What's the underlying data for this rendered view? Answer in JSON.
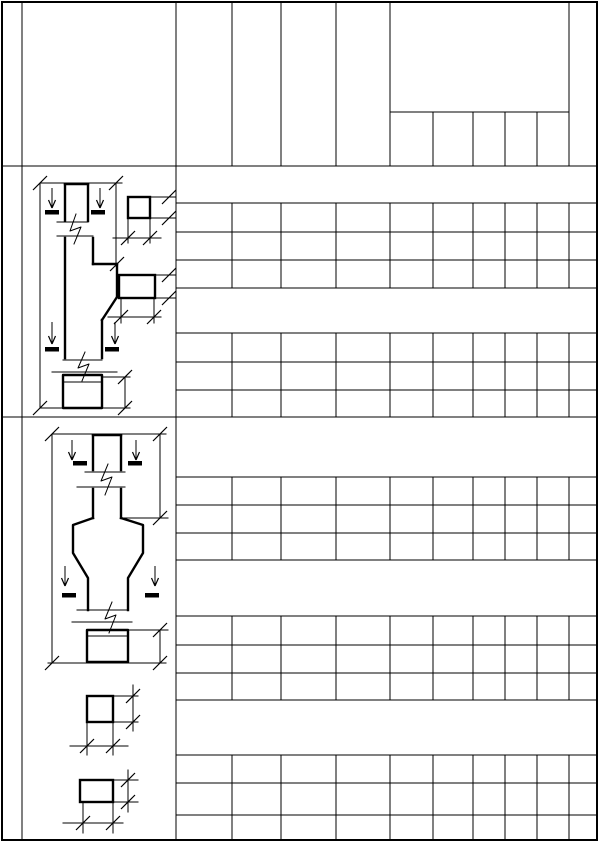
{
  "sheet": {
    "width": 601,
    "height": 842,
    "background": "#ffffff",
    "line_color": "#000000",
    "thin": 1,
    "thick": 2.4,
    "frame_stroke": 2,
    "dash_width": 4.5,
    "tick_len": 7
  },
  "frame": {
    "x": 2,
    "y": 2,
    "w": 595,
    "h": 838
  },
  "grid_page": {
    "segments": [
      [
        22,
        2,
        22,
        840
      ],
      [
        176,
        2,
        176,
        840
      ],
      [
        2,
        166,
        597,
        166
      ],
      [
        2,
        417,
        597,
        417
      ]
    ]
  },
  "grid_header": {
    "segments": [
      [
        232,
        2,
        232,
        166
      ],
      [
        281,
        2,
        281,
        166
      ],
      [
        336,
        2,
        336,
        166
      ],
      [
        390,
        2,
        390,
        166
      ],
      [
        569,
        2,
        569,
        166
      ],
      [
        390,
        112,
        569,
        112
      ],
      [
        433,
        112,
        433,
        166
      ],
      [
        473,
        112,
        473,
        166
      ],
      [
        505,
        112,
        505,
        166
      ],
      [
        537,
        112,
        537,
        166
      ]
    ]
  },
  "schedule": {
    "x_left": 176,
    "x_right": 597,
    "col_xs": [
      232,
      281,
      336,
      390,
      433,
      473,
      505,
      537,
      569
    ],
    "blocks": [
      {
        "top": 203,
        "rows": [
          232,
          260
        ],
        "bottom": 288
      },
      {
        "top": 333,
        "rows": [
          362,
          390
        ],
        "bottom": 417
      },
      {
        "top": 477,
        "rows": [
          505,
          533
        ],
        "bottom": 560
      },
      {
        "top": 616,
        "rows": [
          645,
          673
        ],
        "bottom": 700
      },
      {
        "top": 755,
        "rows": [
          783,
          815
        ],
        "bottom": 840
      }
    ]
  },
  "drawings": {
    "col1": {
      "thick": [
        "M65,184 L88,184",
        "M65,184 L65,221",
        "M88,184 L88,221",
        "M65,238 L65,358",
        "M93,238 L93,264",
        "M93,264 L117,264",
        "M117,264 L117,297",
        "M117,297 L102,320",
        "M102,320 L102,358",
        "M63,375 L102,375 L102,408 L63,408 Z"
      ],
      "thin": [
        "M40,183 L40,408",
        "M40,183 L122,183",
        "M116,184 L116,266",
        "M57,222 L88,222",
        "M57,236 L93,236",
        "M76,214 L70,231 L81,227 L74,244",
        "M63,360 L102,360",
        "M52,372 L117,372",
        "M85,352 L78,368 L89,364 L82,381",
        "M63,382 L102,382",
        "M40,408 L130,408",
        "M102,377 L130,377",
        "M125,377 L125,408"
      ],
      "ticks": [
        [
          40,
          183
        ],
        [
          116,
          183
        ],
        [
          117,
          264
        ],
        [
          40,
          408
        ],
        [
          125,
          408
        ],
        [
          125,
          377
        ]
      ],
      "arrows": [
        [
          52,
          188,
          208
        ],
        [
          100,
          188,
          208
        ],
        [
          52,
          322,
          344
        ],
        [
          115,
          322,
          344
        ]
      ],
      "dashes": [
        [
          45,
          212,
          59
        ],
        [
          91,
          212,
          105
        ],
        [
          45,
          349,
          59
        ],
        [
          105,
          349,
          119
        ]
      ]
    },
    "sec1a": {
      "rects": [
        [
          128,
          197,
          22,
          21
        ]
      ],
      "thin": [
        "M150,197 L176,197",
        "M150,218 L176,218",
        "M128,218 L128,243",
        "M150,218 L150,243",
        "M113,238 L161,238"
      ],
      "ticks": [
        [
          169,
          197
        ],
        [
          169,
          218
        ],
        [
          128,
          238
        ],
        [
          150,
          238
        ]
      ]
    },
    "sec1b": {
      "rects": [
        [
          119,
          275,
          36,
          23
        ]
      ],
      "thin": [
        "M155,275 L176,275",
        "M155,298 L176,298",
        "M121,298 L121,323",
        "M154,298 L154,323",
        "M108,317 L161,317"
      ],
      "ticks": [
        [
          169,
          275
        ],
        [
          169,
          298
        ],
        [
          121,
          317
        ],
        [
          154,
          317
        ]
      ]
    },
    "col2": {
      "thick": [
        "M93,435 L121,435",
        "M93,435 L93,470",
        "M121,435 L121,470",
        "M93,489 L93,518",
        "M121,489 L121,518",
        "M93,518 L73,525 L73,553 L88,578 L88,610",
        "M121,518 L143,525 L143,553 L128,578 L128,610",
        "M87,630 L128,630 L128,662 L87,662 Z"
      ],
      "thin": [
        "M52,434 L52,663",
        "M52,434 L166,434",
        "M160,434 L160,518",
        "M123,518 L168,518",
        "M85,472 L125,472",
        "M77,487 L125,487",
        "M108,464 L101,481 L112,477 L105,495",
        "M77,610 L128,610",
        "M72,622 L132,622",
        "M112,602 L105,619 L116,615 L109,633",
        "M87,636 L128,636",
        "M48,663 L166,663",
        "M128,630 L168,630",
        "M160,630 L160,663"
      ],
      "ticks": [
        [
          52,
          434
        ],
        [
          160,
          434
        ],
        [
          160,
          518
        ],
        [
          52,
          663
        ],
        [
          160,
          663
        ],
        [
          160,
          630
        ]
      ],
      "arrows": [
        [
          72,
          440,
          460
        ],
        [
          136,
          440,
          460
        ],
        [
          65,
          566,
          586
        ],
        [
          155,
          566,
          586
        ]
      ],
      "dashes": [
        [
          73,
          463,
          87
        ],
        [
          128,
          463,
          142
        ],
        [
          62,
          595,
          76
        ],
        [
          145,
          595,
          159
        ]
      ]
    },
    "sec2a": {
      "rects": [
        [
          87,
          696,
          26,
          26
        ]
      ],
      "thin": [
        "M113,696 L138,696",
        "M113,722 L138,722",
        "M133,685 L133,731",
        "M87,722 L87,755",
        "M113,722 L113,755",
        "M70,746 L128,746"
      ],
      "ticks": [
        [
          133,
          696
        ],
        [
          133,
          722
        ],
        [
          87,
          746
        ],
        [
          113,
          746
        ]
      ]
    },
    "sec2b": {
      "rects": [
        [
          80,
          780,
          33,
          22
        ]
      ],
      "thin": [
        "M113,780 L138,780",
        "M113,802 L138,802",
        "M128,770 L128,812",
        "M83,802 L83,833",
        "M113,802 L113,833",
        "M63,823 L123,823"
      ],
      "ticks": [
        [
          128,
          780
        ],
        [
          128,
          802
        ],
        [
          83,
          823
        ],
        [
          113,
          823
        ]
      ]
    }
  }
}
